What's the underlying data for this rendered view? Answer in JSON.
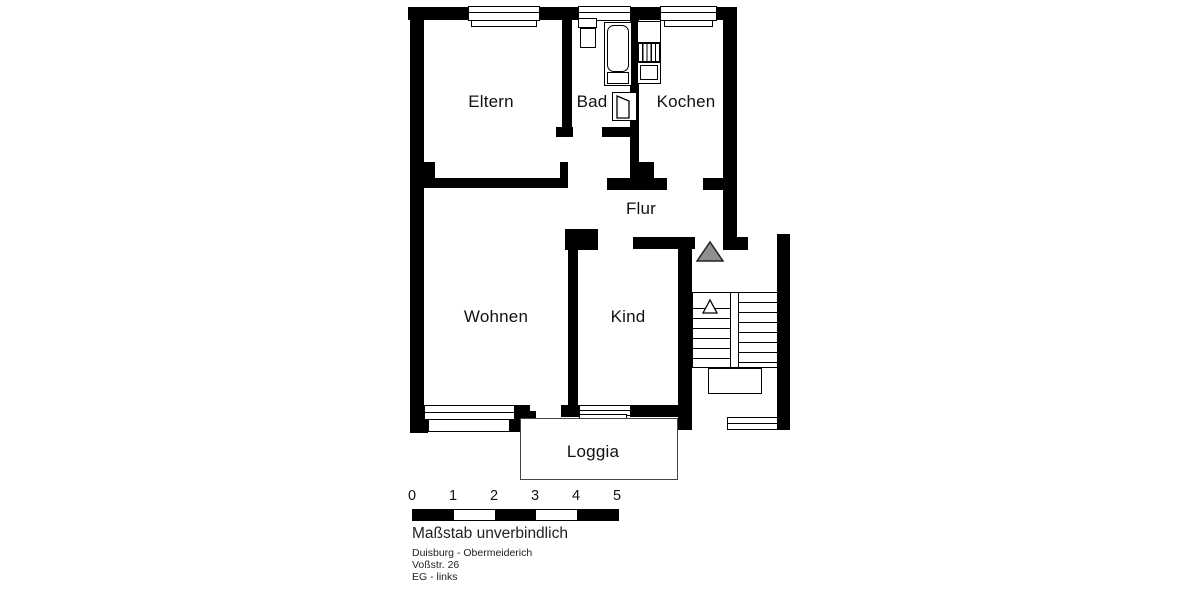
{
  "rooms": [
    {
      "id": "eltern",
      "label": "Eltern",
      "cx": 491,
      "cy": 102
    },
    {
      "id": "bad",
      "label": "Bad",
      "cx": 592,
      "cy": 102
    },
    {
      "id": "kochen",
      "label": "Kochen",
      "cx": 686,
      "cy": 102
    },
    {
      "id": "flur",
      "label": "Flur",
      "cx": 641,
      "cy": 209
    },
    {
      "id": "wohnen",
      "label": "Wohnen",
      "cx": 496,
      "cy": 317
    },
    {
      "id": "kind",
      "label": "Kind",
      "cx": 628,
      "cy": 317
    },
    {
      "id": "loggia",
      "label": "Loggia",
      "cx": 593,
      "cy": 452
    }
  ],
  "scale_bar": {
    "numbers": [
      "0",
      "1",
      "2",
      "3",
      "4",
      "5"
    ],
    "note": "Maßstab unverbindlich",
    "segment_colors": [
      "#000000",
      "#ffffff",
      "#000000",
      "#ffffff",
      "#000000"
    ],
    "bar_x": 412,
    "bar_y": 509,
    "segment_width": 41,
    "numbers_y": 488
  },
  "address": {
    "line1": "Duisburg - Obermeiderich",
    "line2": "Voßstr. 26",
    "line3": "EG - links"
  },
  "colors": {
    "wall": "#000000",
    "entrance_arrow": "#8f8f8f",
    "text": "#1a1a1a"
  },
  "geometry": {
    "solids": [
      [
        "wall-top-1",
        408,
        7,
        60,
        13
      ],
      [
        "wall-top-2",
        540,
        7,
        38,
        13
      ],
      [
        "wall-top-3",
        631,
        7,
        29,
        13
      ],
      [
        "wall-top-4",
        717,
        7,
        20,
        13
      ],
      [
        "wall-left",
        410,
        7,
        14,
        426
      ],
      [
        "wall-left-notch",
        424,
        162,
        11,
        16
      ],
      [
        "wall-bottom-left-corner",
        410,
        420,
        18,
        13
      ],
      [
        "wall-eltern-right",
        562,
        20,
        10,
        117
      ],
      [
        "wall-eltern-right-foot",
        556,
        127,
        17,
        10
      ],
      [
        "wall-eltern-bottom",
        424,
        178,
        144,
        10
      ],
      [
        "wall-eltern-bottom-stub",
        560,
        162,
        8,
        17
      ],
      [
        "wall-bad-bottom",
        602,
        127,
        31,
        10
      ],
      [
        "wall-bad-kochen",
        630,
        7,
        9,
        173
      ],
      [
        "wall-bad-kochen-foot",
        634,
        162,
        20,
        17
      ],
      [
        "wall-flur-top-left",
        607,
        178,
        60,
        12
      ],
      [
        "wall-flur-top-right",
        703,
        178,
        32,
        12
      ],
      [
        "wall-right",
        723,
        7,
        14,
        243
      ],
      [
        "wall-right-foot",
        723,
        237,
        25,
        13
      ],
      [
        "chimney-block",
        565,
        229,
        33,
        21
      ],
      [
        "wall-kind-left",
        568,
        248,
        10,
        160
      ],
      [
        "wall-kind-left-foot",
        561,
        405,
        21,
        12
      ],
      [
        "wall-kind-top",
        633,
        237,
        62,
        12
      ],
      [
        "wall-kind-bottom",
        630,
        405,
        50,
        12
      ],
      [
        "wall-stairwell-left",
        678,
        237,
        14,
        193
      ],
      [
        "wall-wohnen-bottom-block",
        509,
        405,
        21,
        27
      ],
      [
        "wall-wohnen-bottom-nub",
        530,
        411,
        6,
        7
      ],
      [
        "wall-stairwell-right",
        777,
        234,
        13,
        196
      ]
    ],
    "boxes": [
      {
        "n": "window-eltern",
        "x": 468,
        "y": 6,
        "w": 72,
        "h": 15
      },
      {
        "n": "window-eltern-sill",
        "x": 471,
        "y": 20,
        "w": 66,
        "h": 7
      },
      {
        "n": "window-bad",
        "x": 578,
        "y": 6,
        "w": 53,
        "h": 15
      },
      {
        "n": "window-kochen",
        "x": 660,
        "y": 6,
        "w": 57,
        "h": 15
      },
      {
        "n": "window-kochen-sill",
        "x": 664,
        "y": 20,
        "w": 49,
        "h": 7
      },
      {
        "n": "washbasin-top",
        "x": 578,
        "y": 18,
        "w": 19,
        "h": 10
      },
      {
        "n": "washbasin",
        "x": 580,
        "y": 28,
        "w": 16,
        "h": 20
      },
      {
        "n": "bathtub-outer",
        "x": 604,
        "y": 22,
        "w": 28,
        "h": 64
      },
      {
        "n": "bathtub-inner",
        "x": 607,
        "y": 25,
        "w": 22,
        "h": 47,
        "r": 7
      },
      {
        "n": "bathtub-foot",
        "x": 607,
        "y": 72,
        "w": 22,
        "h": 12
      },
      {
        "n": "kitchen-counter",
        "x": 637,
        "y": 21,
        "w": 24,
        "h": 22
      },
      {
        "n": "kitchen-sink",
        "x": 637,
        "y": 62,
        "w": 24,
        "h": 22
      },
      {
        "n": "kitchen-sink-basin",
        "x": 640,
        "y": 65,
        "w": 18,
        "h": 15,
        "b": 1
      },
      {
        "n": "bad-door-frame",
        "x": 612,
        "y": 92,
        "w": 25,
        "h": 29,
        "b": 1.6
      },
      {
        "n": "window-wohnen",
        "x": 424,
        "y": 405,
        "w": 91,
        "h": 15
      },
      {
        "n": "window-wohnen-sill",
        "x": 428,
        "y": 419,
        "w": 82,
        "h": 13
      },
      {
        "n": "window-kind",
        "x": 579,
        "y": 405,
        "w": 52,
        "h": 11
      },
      {
        "n": "window-kind-sill",
        "x": 579,
        "y": 414,
        "w": 48,
        "h": 9
      },
      {
        "n": "loggia-outline",
        "x": 520,
        "y": 418,
        "w": 158,
        "h": 62,
        "b": 1,
        "c": "#444444"
      },
      {
        "n": "stairs-box",
        "x": 692,
        "y": 292,
        "w": 86,
        "h": 76,
        "b": 1.5
      },
      {
        "n": "stairs-stringer",
        "x": 730,
        "y": 292,
        "w": 9,
        "h": 76,
        "b": 1.5
      },
      {
        "n": "stairs-landing",
        "x": 708,
        "y": 368,
        "w": 54,
        "h": 26,
        "b": 1.5
      },
      {
        "n": "window-stairwell",
        "x": 727,
        "y": 417,
        "w": 51,
        "h": 13
      }
    ],
    "lines": [
      [
        468,
        12,
        72,
        1.2
      ],
      [
        578,
        12,
        53,
        1.2
      ],
      [
        660,
        12,
        57,
        1.2
      ],
      [
        424,
        412,
        91,
        1.2
      ],
      [
        579,
        410,
        52,
        1.2
      ],
      [
        727,
        423,
        51,
        1.2
      ],
      [
        739,
        302,
        38,
        1.2
      ],
      [
        739,
        312,
        38,
        1.2
      ],
      [
        739,
        322,
        38,
        1.2
      ],
      [
        739,
        332,
        38,
        1.2
      ],
      [
        739,
        342,
        38,
        1.2
      ],
      [
        739,
        352,
        38,
        1.2
      ],
      [
        739,
        362,
        38,
        1.2
      ],
      [
        692,
        308,
        38,
        1.2
      ],
      [
        692,
        318,
        38,
        1.2
      ],
      [
        692,
        328,
        38,
        1.2
      ],
      [
        692,
        338,
        38,
        1.2
      ],
      [
        692,
        348,
        38,
        1.2
      ],
      [
        692,
        358,
        38,
        1.2
      ]
    ],
    "hatches": [
      {
        "n": "kitchen-stove",
        "x": 637,
        "y": 43,
        "w": 24,
        "h": 19
      }
    ],
    "polygons": [
      {
        "n": "entrance-arrow",
        "points": "710,242 697,261 723,261",
        "fill": "#8f8f8f",
        "stroke": "#222222",
        "sw": 1.5
      },
      {
        "n": "stairs-direction-arrow",
        "points": "710,300 703,313 717,313",
        "fill": "#ffffff",
        "stroke": "#000000",
        "sw": 1.3
      },
      {
        "n": "bad-door-leaf",
        "points": "617,118 617,96 629,101 629,118",
        "fill": "#ffffff",
        "stroke": "#000000",
        "sw": 1.3
      }
    ]
  }
}
